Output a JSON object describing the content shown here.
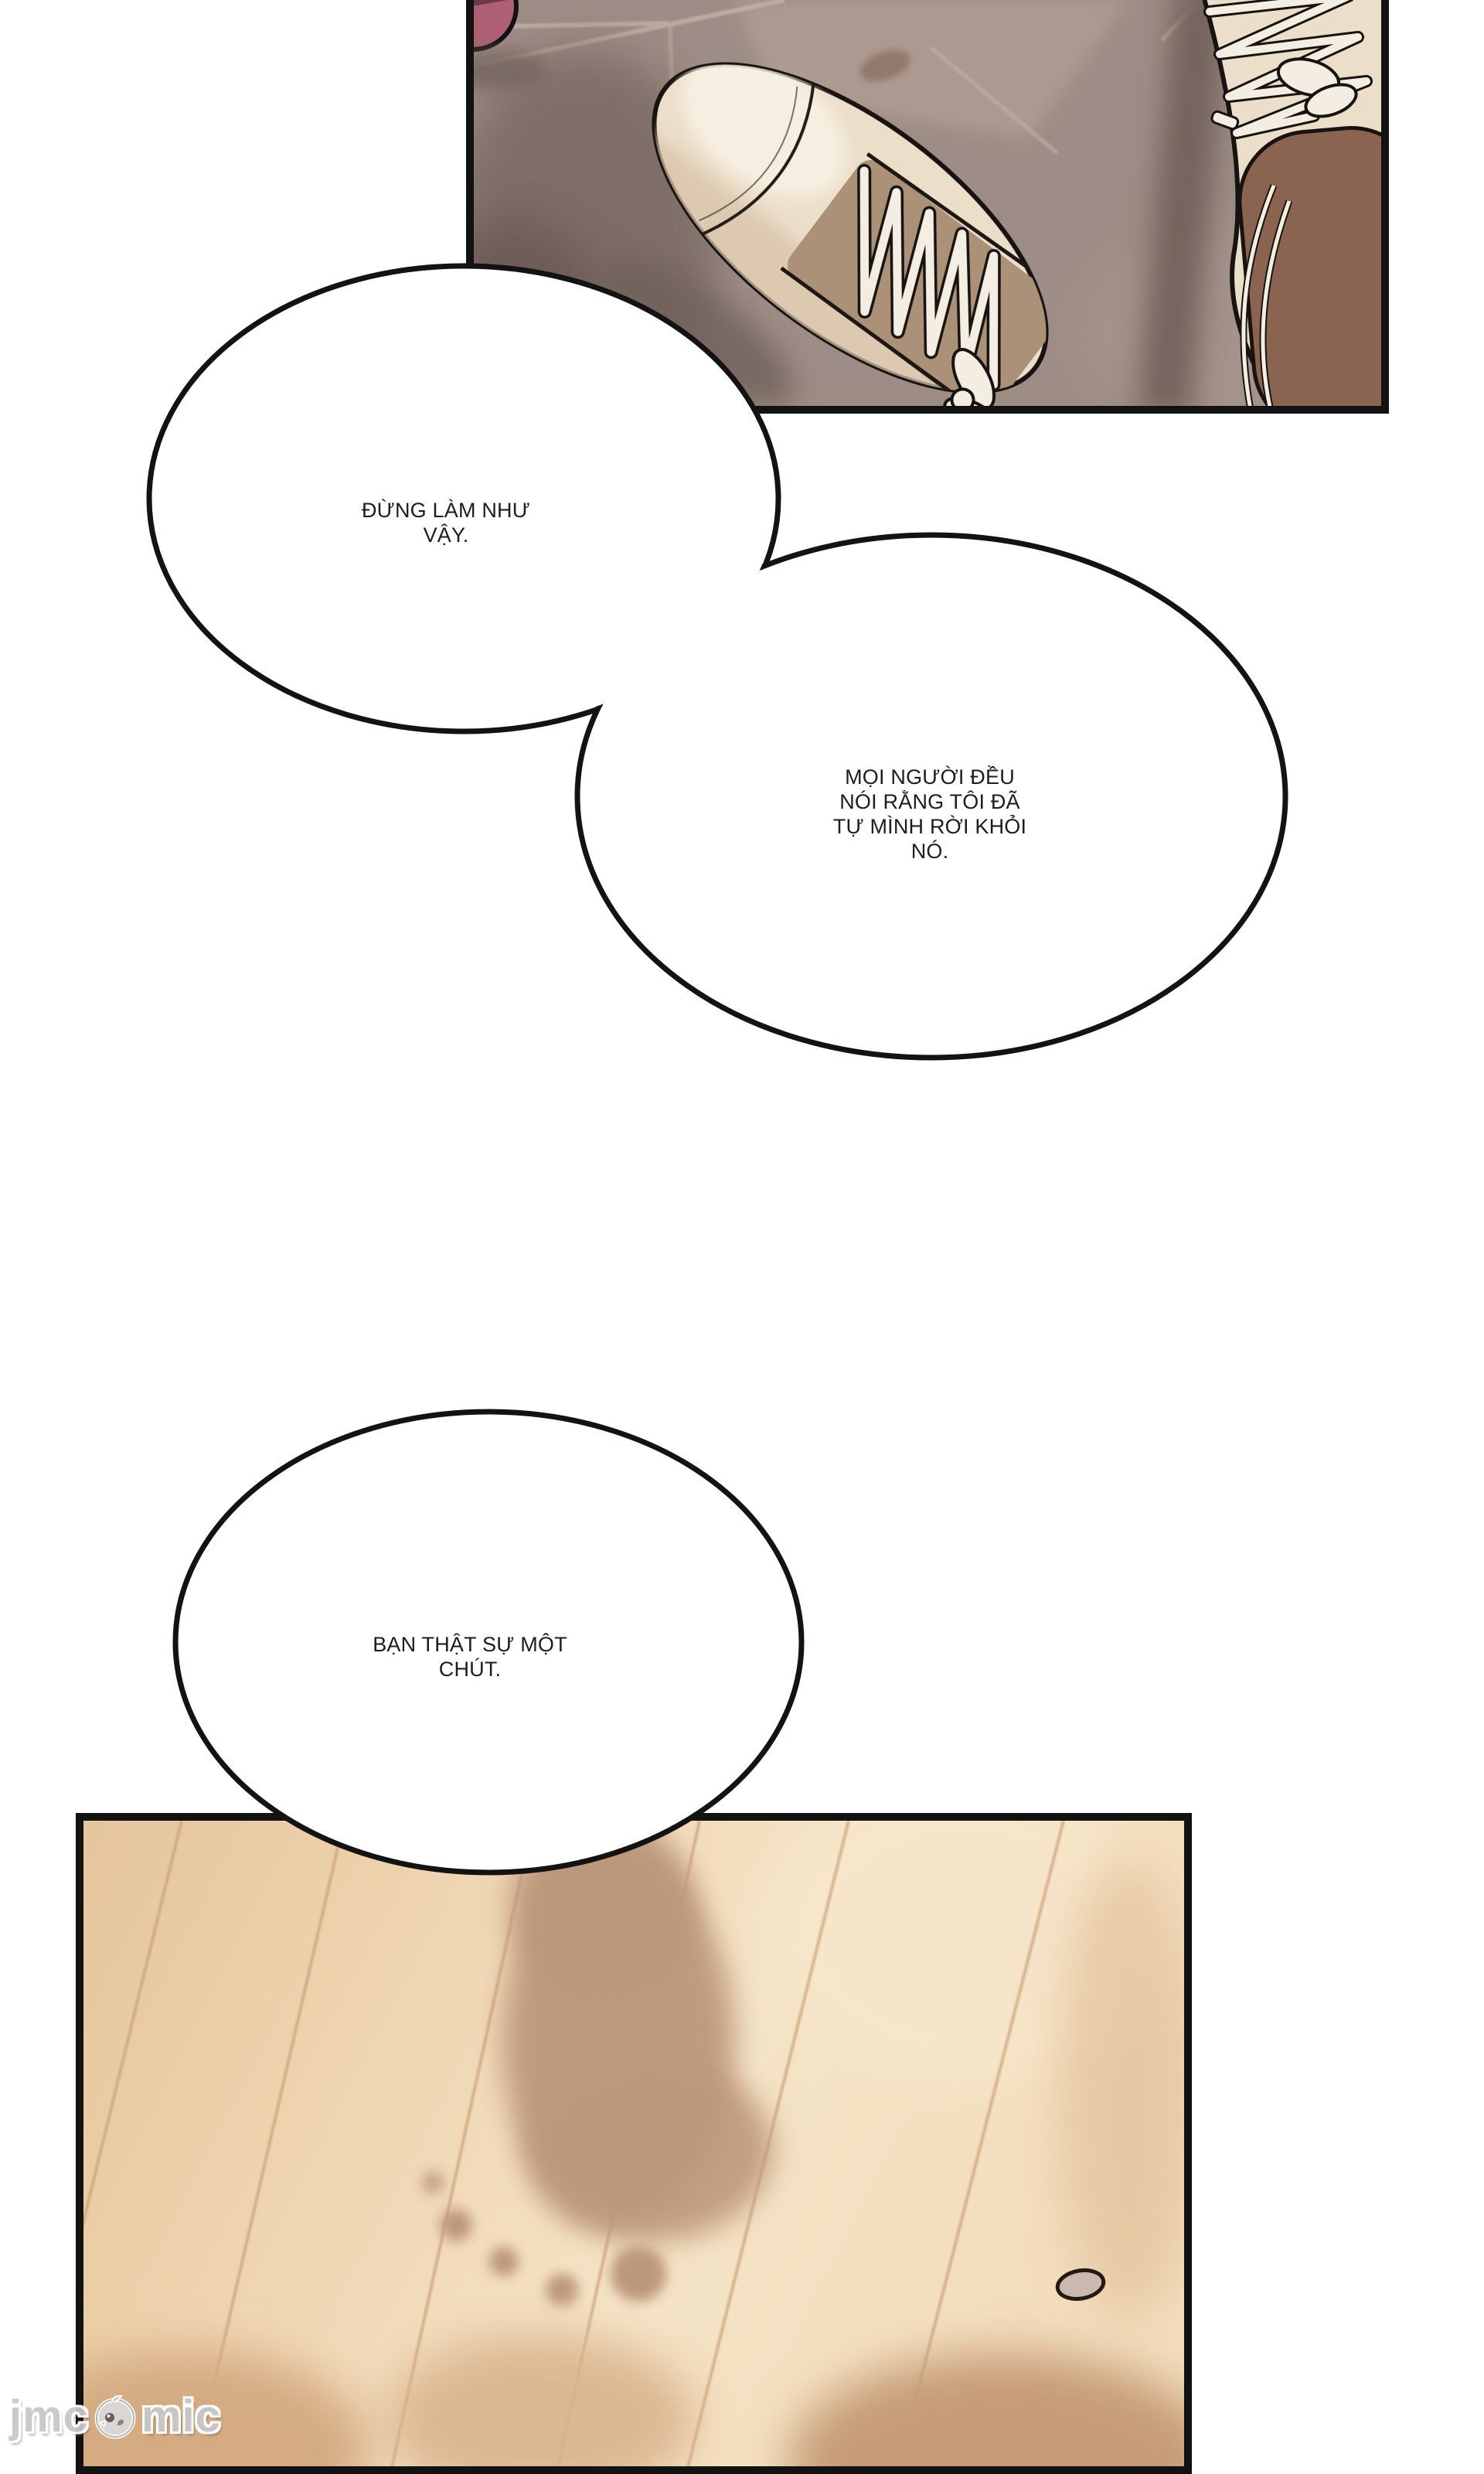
{
  "speech_bubbles": [
    {
      "text": "ĐỪNG LÀM NHƯ\nVẬY."
    },
    {
      "text": "MỌI NGƯỜI ĐỀU\nNÓI RẰNG TÔI ĐÃ\nTỰ MÌNH RỜI KHỎI\nNÓ."
    },
    {
      "text": "BẠN THẬT SỰ MỘT\nCHÚT."
    }
  ],
  "watermark": {
    "prefix": "jmc",
    "suffix": "mic",
    "mascot_icon": "chick-mascot-icon"
  },
  "palette": {
    "page_background": "#ffffff",
    "panel_border": "#121212",
    "bubble_outline": "#131313",
    "bubble_fill": "#ffffff",
    "text_color": "#1d1d1d",
    "tile_floor": "#9e8d86",
    "tile_grout": "#c2b1a5",
    "sneaker_body": "#ecdfca",
    "sneaker_patch_brown": "#8a6450",
    "lace_white": "#f4eee2",
    "pink_object": "#ad6073",
    "wood_floor_light": "#f3e1c2",
    "wood_floor_dark": "#e4c59c",
    "wood_plank_line": "#c99f74",
    "footprint_shadow": "#bd977b",
    "watermark_gray": "#c8c8c8"
  }
}
